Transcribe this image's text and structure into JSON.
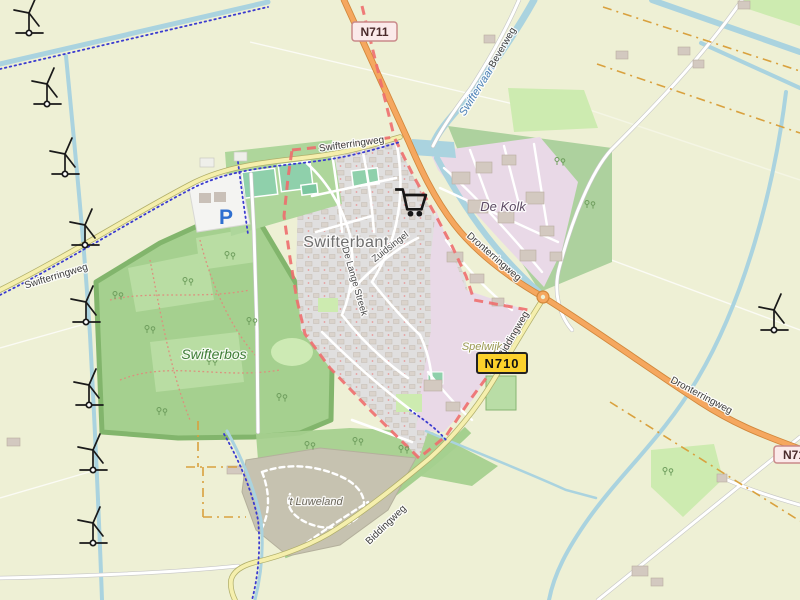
{
  "map": {
    "badges": {
      "n711": "N711",
      "n710": "N710",
      "n71": "N71"
    },
    "places": {
      "town": "Swifterbant",
      "industrial": "De Kolk",
      "forest": "Swifterbos",
      "hamlet": "Spelwijk",
      "scrub": "'t Luweland"
    },
    "roads": {
      "swifterringweg": "Swifterringweg",
      "dronterringweg": "Dronterringweg",
      "biddingweg": "Biddingweg",
      "beverweg": "Beverweg",
      "zuidsingel": "Zuidsingel",
      "de_lange_streek": "De Lange Streek"
    },
    "water": {
      "canal": "Swiftervaart"
    },
    "symbols": {
      "parking": "P"
    },
    "icons": {
      "wind_turbine": "wind-turbine",
      "supermarket_cart": "shopping-cart",
      "parking_sign": "parking-p"
    },
    "colors": {
      "farmland": "#eef0d5",
      "meadow": "#cdebb0",
      "forest": "#a5d08f",
      "forest_band": "#add19e",
      "residential": "#e0dfdf",
      "industrial": "#e9d9e7",
      "scrub": "#c6c2b0",
      "water": "#aad3df",
      "trunk_road": "#f5a75f",
      "secondary_road": "#f5efad",
      "boundary_red": "#ee6e6e",
      "route_blue": "#3b3bd0",
      "admin_orange": "#d9a13e",
      "badge_yellow": "#fcd12b",
      "badge_pink": "#fbeaea"
    }
  }
}
